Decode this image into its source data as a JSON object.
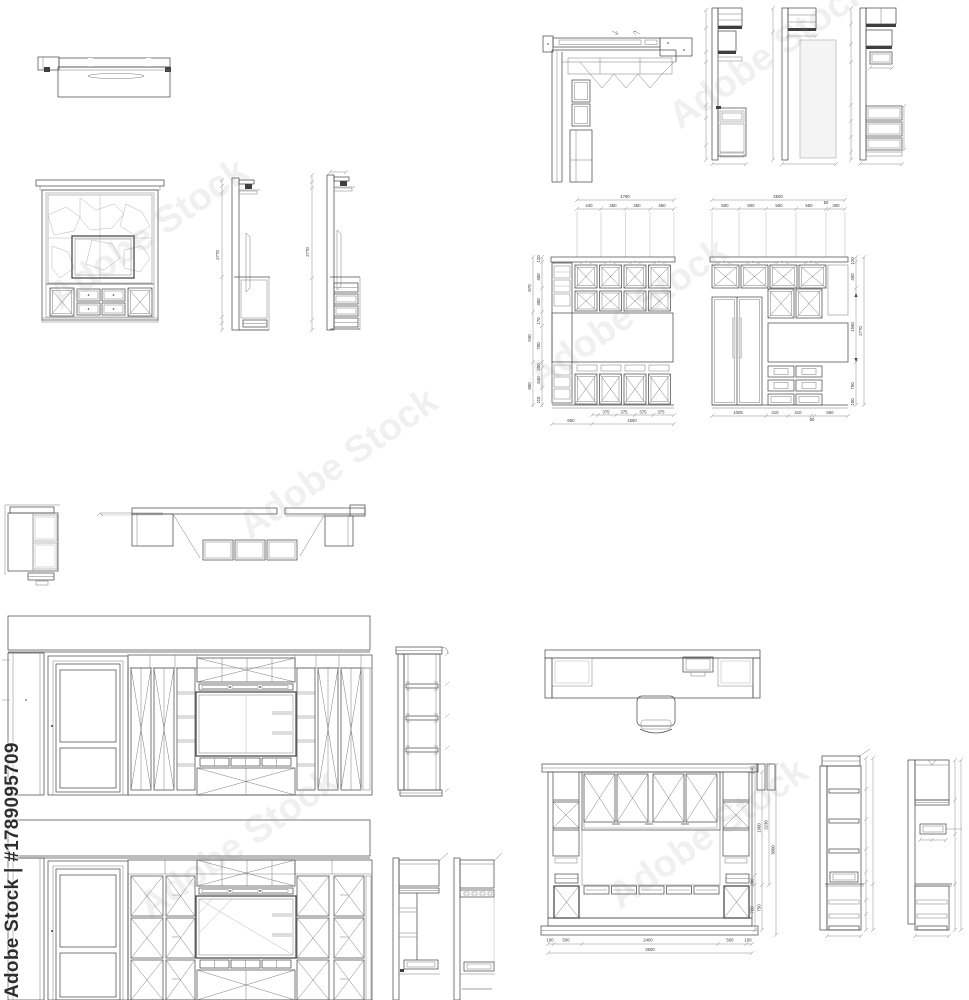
{
  "watermark": {
    "side_text": "Adobe Stock | #1789095709",
    "ghost_text": "Adobe Stock"
  },
  "colors": {
    "line": "#4d4d4d",
    "hatch": "#a8a8a8",
    "backsplash": "#b8b8b8",
    "paper": "#ffffff"
  },
  "tv_sections": {
    "height_a": "2770",
    "height_b": "2770"
  },
  "kitchen_elev_1": {
    "top_total": "1790",
    "top_dims": [
      "440",
      "450",
      "450",
      "450"
    ],
    "left_dims": [
      "120",
      "400",
      "400",
      "170",
      "700",
      "200",
      "540",
      "110",
      "870",
      "930",
      "800"
    ],
    "bottom_dims": [
      "375",
      "375",
      "375",
      "375"
    ],
    "bottom_totals": [
      "650",
      "1550"
    ]
  },
  "kitchen_elev_2": {
    "top_total": "2500",
    "top_dims": [
      "500",
      "500",
      "550",
      "550",
      "50",
      "300"
    ],
    "right_dims": [
      "120",
      "450",
      "1560",
      "750",
      "100"
    ],
    "right_total": "2770",
    "bottom_dims": [
      "1005",
      "410",
      "410",
      "50",
      "650"
    ]
  },
  "desk_elev": {
    "right_dims": [
      "140",
      "1900",
      "3230",
      "3000",
      "200",
      "750",
      "720"
    ],
    "bottom_dims": [
      "100",
      "500",
      "2400",
      "500",
      "100"
    ],
    "bottom_total": "3600"
  }
}
